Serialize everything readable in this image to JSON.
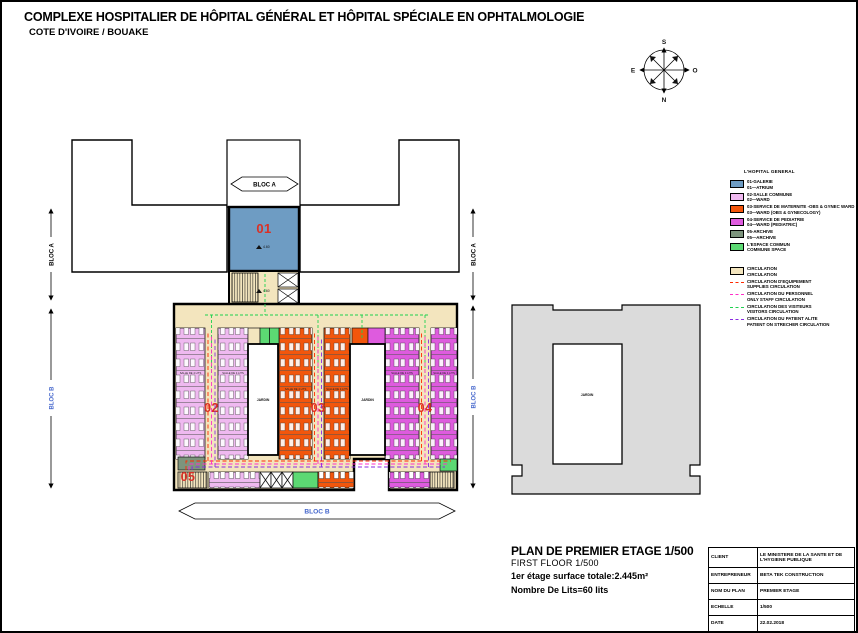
{
  "header": {
    "title": "COMPLEXE HOSPITALIER DE HÔPITAL GÉNÉRAL ET HÔPITAL SPÉCIALE EN OPHTALMOLOGIE",
    "subtitle": "COTE D'IVOIRE / BOUAKE"
  },
  "compass": {
    "s": "S",
    "n": "N",
    "e": "E",
    "o": "O"
  },
  "legend": {
    "header": "L'HOPITAL GENERAL",
    "items": [
      {
        "fr": "01-GALERIE",
        "en": "01—ATRIUM",
        "color": "#6E9CC3"
      },
      {
        "fr": "02-SALLE COMMUNE",
        "en": "02—WARD",
        "color": "#EFB9F0"
      },
      {
        "fr": "03-SERVICE DE MATERNITE -OBS & GYNEC WARD",
        "en": "03—WARD (OBS & GYNECOLOGY)",
        "color": "#F2560C"
      },
      {
        "fr": "04-SERVICE DE PEDIATRIE",
        "en": "04—WARD (PEDIATRIC)",
        "color": "#DE5BDE"
      },
      {
        "fr": "05-ARCHIVE",
        "en": "05—ARCHIVE",
        "color": "#7D947D"
      },
      {
        "fr": "L'ESPACE COMMUN",
        "en": "COMMUNE SPACE",
        "color": "#5CD973"
      }
    ],
    "circulation": [
      {
        "fr": "CIRCULATION",
        "en": "CIRCULATION",
        "color": "#F3E5BE",
        "style": "fill"
      },
      {
        "fr": "CIRCULATION D'EQUIPEMENT",
        "en": "SUPPLIES CIRCULATION",
        "color": "#FF2A00",
        "style": "dash"
      },
      {
        "fr": "CIRCULATION DU PERSONNEL",
        "en": "ONLY STAFF CIRCULATION",
        "color": "#FF2EC8",
        "style": "dash"
      },
      {
        "fr": "CIRCULATION DES VISITEURS",
        "en": "VISITORS CIRCULATION",
        "color": "#1FD14F",
        "style": "dash"
      },
      {
        "fr": "CIRCULATION DU PATIENT ALITE",
        "en": "PATIENT ON STRECHER CIRCULATION",
        "color": "#8A2BE2",
        "style": "dash"
      }
    ]
  },
  "plan": {
    "labels": {
      "bloc_a": "BLOC A",
      "bloc_b": "BLOC B"
    },
    "numbers": {
      "n01": "01",
      "n02": "02",
      "n03": "03",
      "n04": "04",
      "n05": "05"
    },
    "courtyard_label": "JARDIN",
    "room_label": "SALLE DE 4 LITS",
    "level_marker": "4.60",
    "palette": {
      "atrium_blue": "#6E9CC3",
      "ward_lilac": "#EFB9F0",
      "ward_orange": "#F2560C",
      "ward_magenta": "#DE5BDE",
      "archive_green": "#7D947D",
      "common_green": "#5CD973",
      "circulation_cream": "#F3E5BE",
      "grey_building": "#DBDBDB",
      "number_red": "#D93025",
      "bloc_b_blue": "#4466CC"
    }
  },
  "notes": {
    "line1": "PLAN DE PREMIER ETAGE 1/500",
    "line2": "FIRST FLOOR 1/500",
    "line3": "1er étage surface totale:2.445m²",
    "line4": "Nombre De Lits=60 lits"
  },
  "title_block": {
    "rows": [
      {
        "label": "CLIENT",
        "value": "LE MINISTERE DE LA SANTE ET DE L'HYGIENE PUBLIQUE"
      },
      {
        "label": "ENTREPRENEUR",
        "value": "BETA TEK CONSTRUCTION"
      },
      {
        "label": "NOM DU PLAN",
        "value": "PREMIER ETAGE"
      },
      {
        "label": "ECHELLE",
        "value": "1/500"
      },
      {
        "label": "DATE",
        "value": "22.02.2018"
      }
    ]
  }
}
